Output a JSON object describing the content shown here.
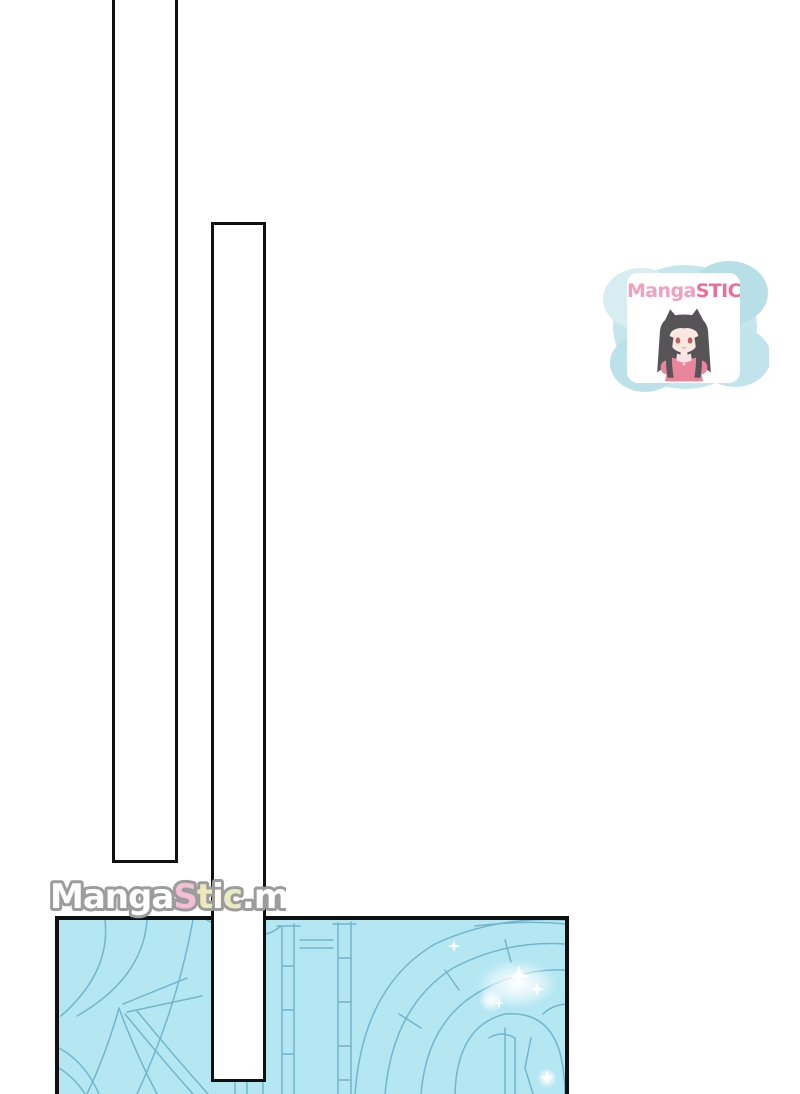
{
  "page": {
    "background": "#ffffff"
  },
  "bars": {
    "fill": "#ffffff",
    "border": "#101010"
  },
  "art_panel": {
    "fill": "#b5e7f3",
    "line": "#72b6cd",
    "border": "#101010",
    "subject": "castle-archway-line-art"
  },
  "watermark": {
    "text": "MangaStic.me",
    "outline": "#9c9c9c",
    "letters": [
      {
        "ch": "M",
        "color": "#ffffff"
      },
      {
        "ch": "a",
        "color": "#ffffff"
      },
      {
        "ch": "n",
        "color": "#ffffff"
      },
      {
        "ch": "g",
        "color": "#ffffff"
      },
      {
        "ch": "a",
        "color": "#ffffff"
      },
      {
        "ch": "S",
        "color": "#f4bed4"
      },
      {
        "ch": "t",
        "color": "#efe9ba"
      },
      {
        "ch": "i",
        "color": "#fcfbf2"
      },
      {
        "ch": "c",
        "color": "#e8ecc1"
      },
      {
        "ch": ".",
        "color": "#ffffff"
      },
      {
        "ch": "m",
        "color": "#ffffff"
      },
      {
        "ch": "e",
        "color": "#ffffff"
      }
    ]
  },
  "logo": {
    "brand_first": "Manga",
    "brand_second": "STIC",
    "brand_first_color": "#f18bb0",
    "brand_second_color": "#e94e85",
    "blob_base": "#b9e1e9",
    "blob_light": "#cfeaf0",
    "blob_dark": "#a8d9e4",
    "card_bg": "#ffffff",
    "mascot": "cat-ear-girl"
  }
}
